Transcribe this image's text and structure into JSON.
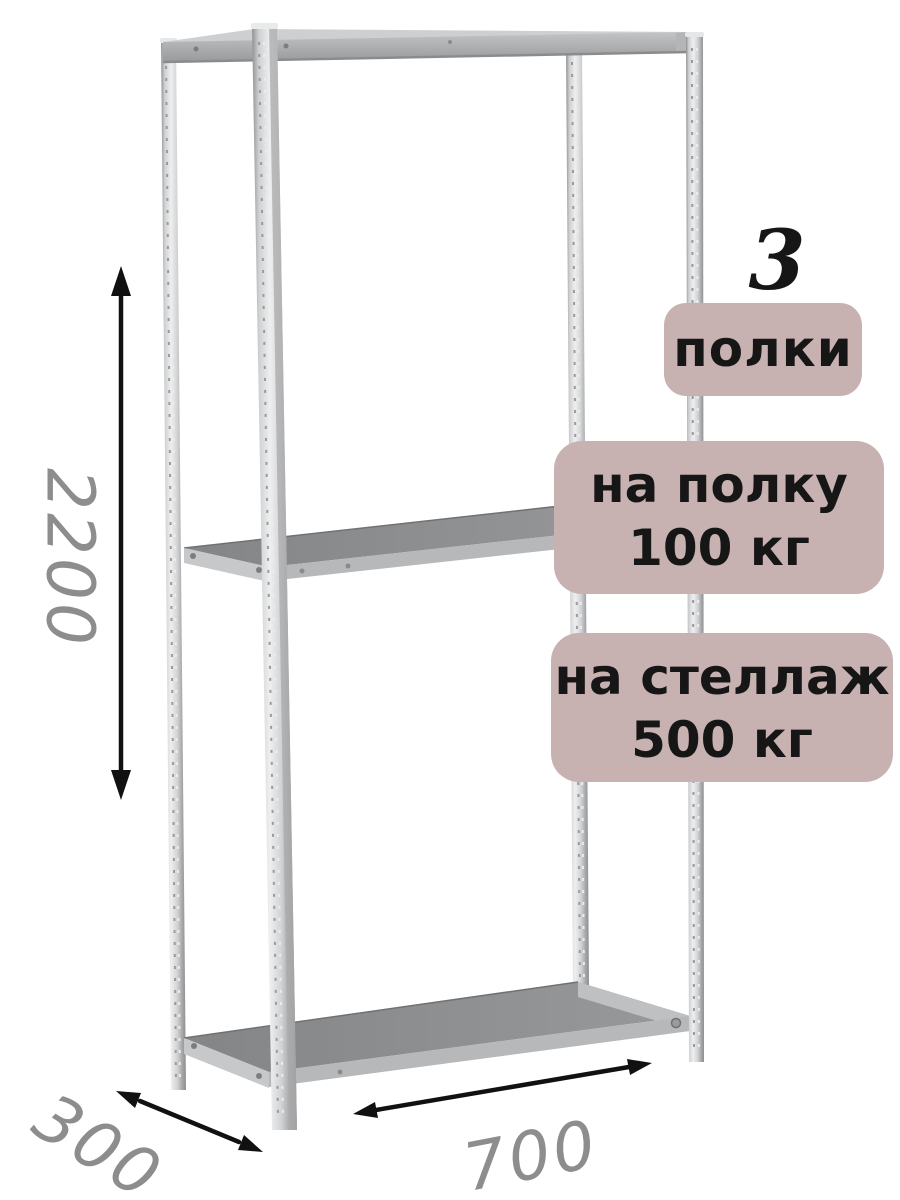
{
  "annotations": {
    "shelf_count": {
      "number": "3",
      "label": "полки"
    },
    "shelf_load": {
      "line1": "на полку",
      "line2": "100 кг"
    },
    "rack_load": {
      "line1": "на стеллаж",
      "line2": "500 кг"
    }
  },
  "dimensions": {
    "height": "2200",
    "depth": "300",
    "width": "700"
  },
  "icons": {
    "height_arrow": "vertical double-headed dimension arrow",
    "depth_arrow": "diagonal double-headed dimension arrow",
    "width_arrow": "horizontal double-headed dimension arrow"
  },
  "colors": {
    "badge_bg": "#c8b1b1",
    "badge_text": "#161616",
    "dim_text": "#8d8d8d",
    "arrow": "#111111",
    "bg": "#ffffff",
    "metal_light": "#eeeff0",
    "metal_mid": "#adafb1",
    "shelf_surface": "#8d8f91"
  }
}
